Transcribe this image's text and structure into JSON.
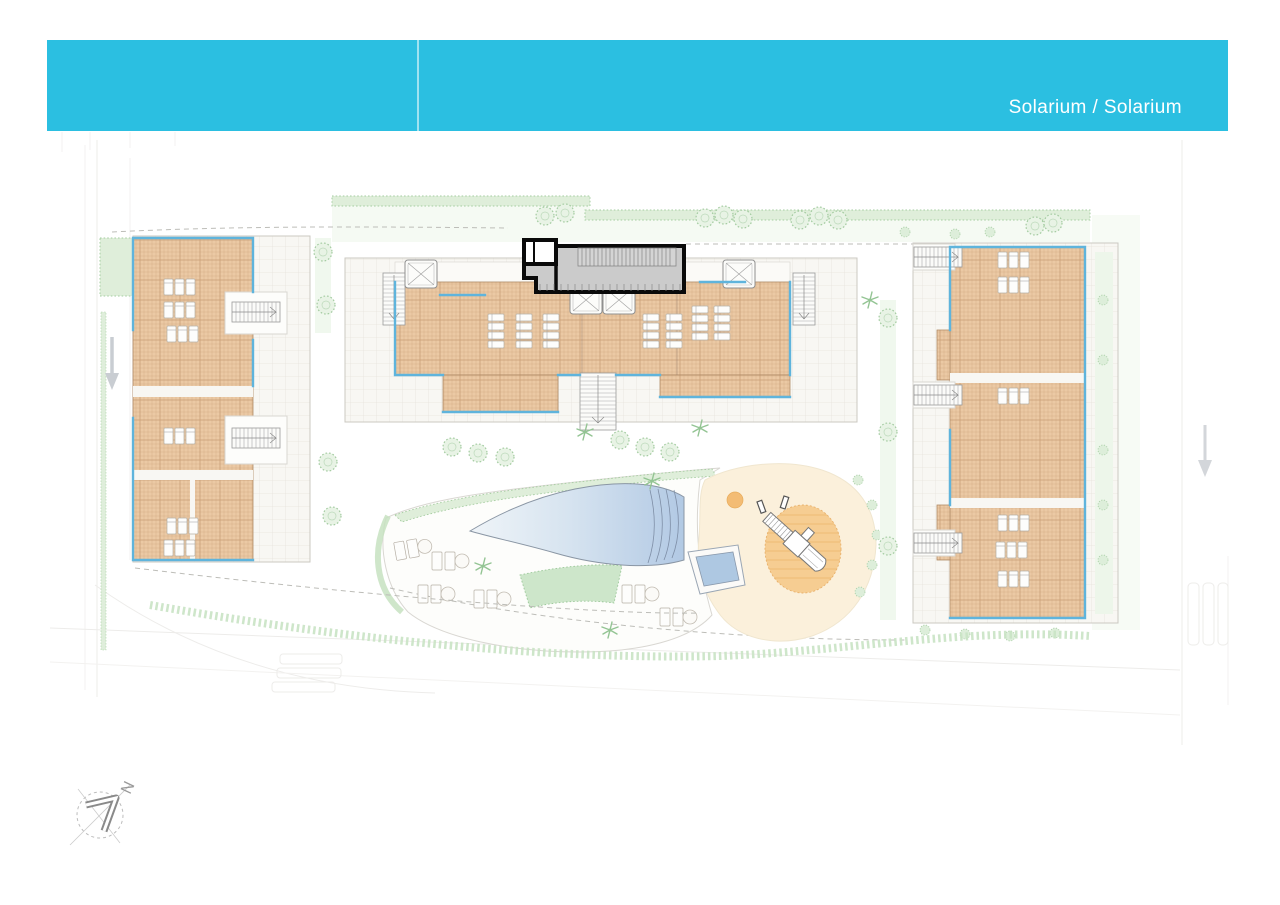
{
  "header": {
    "title": "Solarium / Solarium"
  },
  "compass": {
    "north_label": "N"
  },
  "plan": {
    "level_name": "Solarium",
    "features": [
      "left-apartment-block-roof-terraces",
      "central-apartment-block-roof-terraces",
      "right-apartment-block-roof-terraces",
      "highlighted-solarium-unit",
      "communal-pool",
      "kids-pool",
      "playground",
      "gardens",
      "access-roads"
    ]
  },
  "colors": {
    "header_bg": "#2BBFE1",
    "header_text": "#FFFFFF",
    "tile_fill": "#EBC9A4",
    "tile_line": "#C79B72",
    "tile_edge": "#B08A66",
    "pave_fill": "#F8F7F3",
    "pave_line": "#E7E4DD",
    "blue_edge": "#5FB4DC",
    "green_fill": "#DFEEDA",
    "green_line": "#A6CDA1",
    "green_pale": "#F3F9F1",
    "pool_light": "#EFF4F8",
    "pool_dark": "#B2C9E4",
    "pool_line": "#8A96A4",
    "lawn_fill": "#CDE6CA",
    "play_base": "#FBF0DB",
    "play_circle": "#F6CD92",
    "play_small": "#F3BC74",
    "highlight_stroke": "#0A0A0A",
    "highlight_fill": "#CBCBCB",
    "gray_arrow": "#C9CDD2",
    "road_line": "#EDECEA",
    "dash_line": "#BDBDB8"
  }
}
